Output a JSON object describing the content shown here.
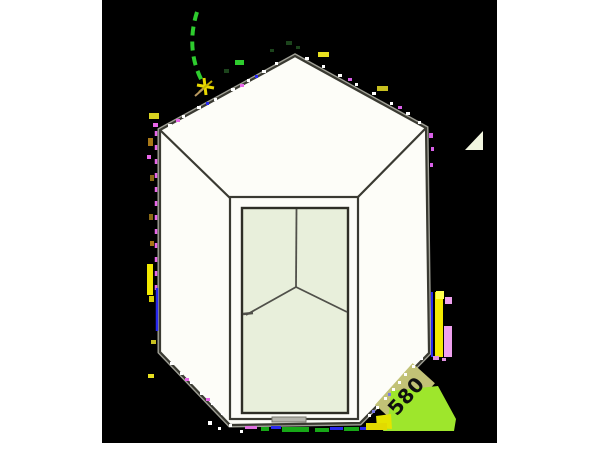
{
  "drawing": {
    "title": "Corner wall cabinet with glass door - product drawing",
    "dimension_label": "580"
  },
  "colors": {
    "background": "#000000",
    "page": "#ffffff",
    "cabinet_fill": "#fdfdf8",
    "outline_dark": "#3a3a32",
    "outline_light": "#a0a096",
    "glass_fill": "#e8efdb",
    "interior_line": "#50504a",
    "handle_fill": "#b4b4ac",
    "sketch_green": "#2ecc2e",
    "artifact_yellow": "#f2ea00",
    "artifact_magenta": "#e866e8",
    "artifact_pink": "#eea0ee",
    "artifact_blue": "#2828ee",
    "dash_green": "#17a817",
    "highlight_green": "#9ee62c",
    "khaki_patch": "#c2c276",
    "cream_triangle": "#f2f6e0",
    "label_color": "#101010"
  }
}
